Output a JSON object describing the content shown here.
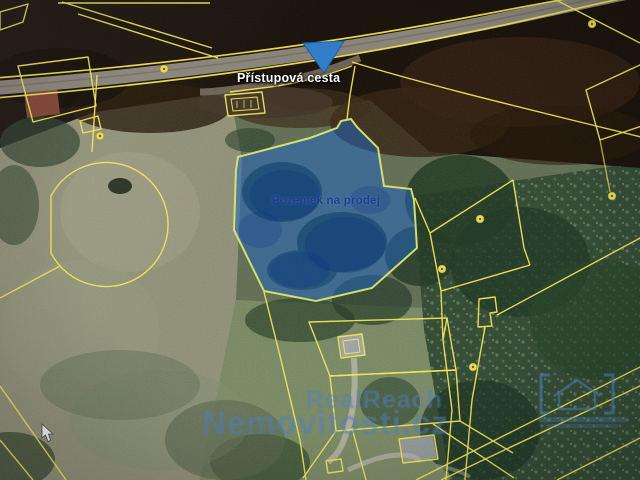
{
  "map": {
    "annotations": {
      "access_road_label": "Přístupová cesta",
      "parcel_label": "Pozemek na prodej"
    },
    "watermark": {
      "brand_line1": "RealReach",
      "brand_line2": "Nemovitosti.cz"
    },
    "colors": {
      "cadastral_line": "#f0e54d",
      "highlight_parcel_fill": "#1d66cc",
      "highlight_parcel_stroke": "#d9e765",
      "marker_blue": "#2e7ecf",
      "watermark_blue": "#4f7fc4",
      "access_label_text": "#ffffff",
      "parcel_label_text": "#1d3f93",
      "road_gray": "#8a8478"
    },
    "icons": {
      "marker": "location-marker-icon",
      "cursor": "cursor-icon",
      "brand_logo": "brand-logo-brackets-icon",
      "landuse": "landuse-symbol-icon"
    }
  }
}
